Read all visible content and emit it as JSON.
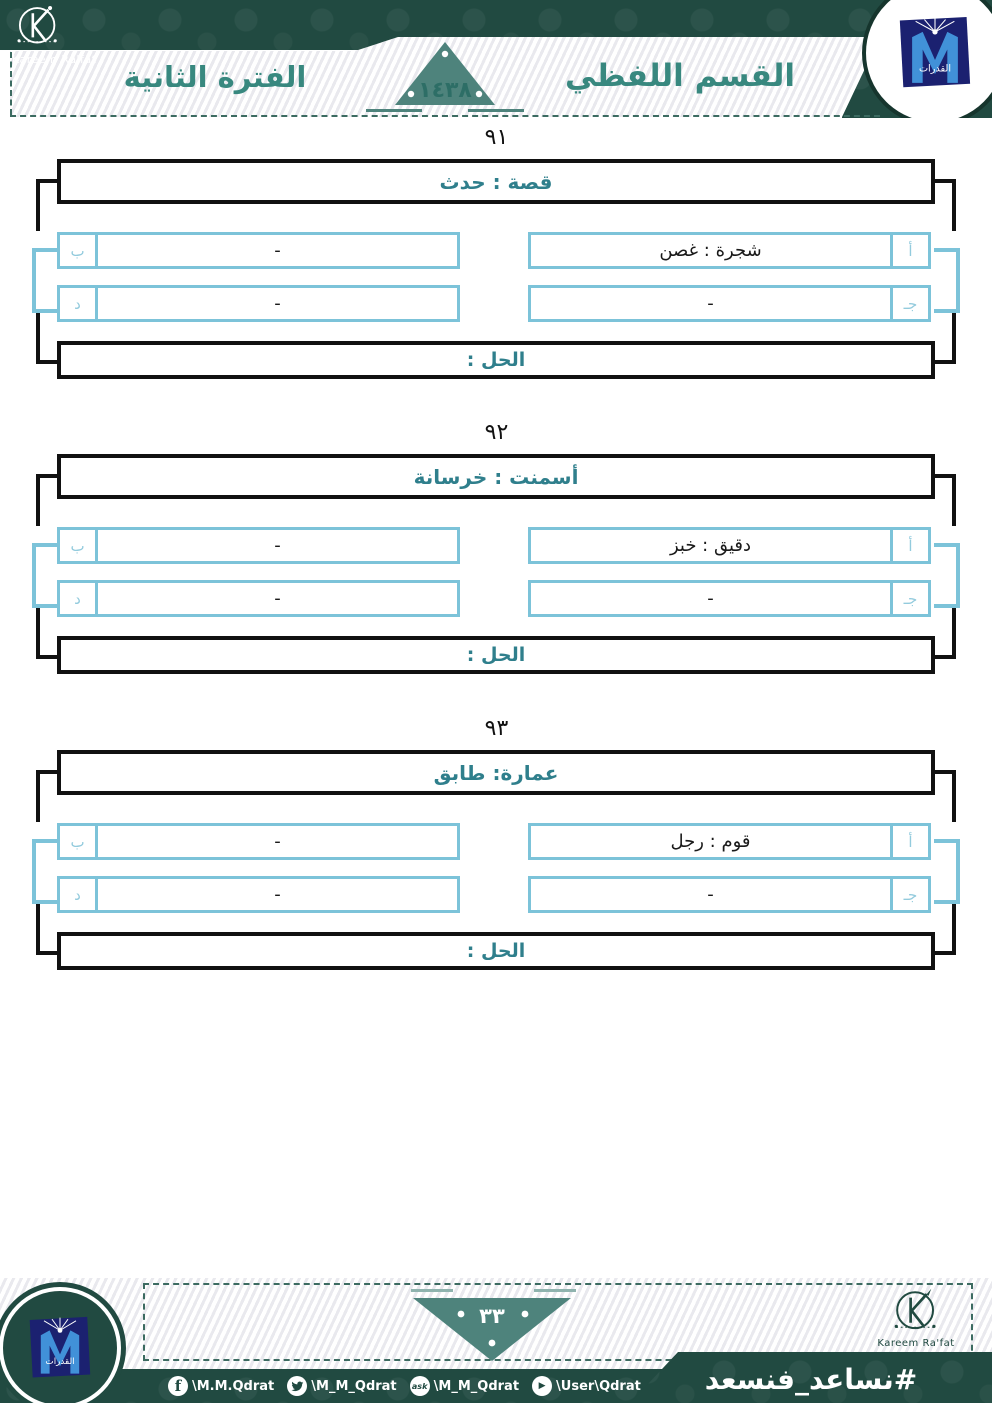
{
  "header": {
    "brand": {
      "name": "Kareem Ra'fat",
      "initial": "K"
    },
    "section_title": "القسم اللفظي",
    "period_title": "الفترة الثانية",
    "year": "١٤٣٨",
    "qudrat_logo_text": "القدرات"
  },
  "questions": [
    {
      "number": "٩١",
      "title": "قصة : حدث",
      "options": [
        {
          "label": "أ",
          "text": "شجرة : غصن"
        },
        {
          "label": "ب",
          "text": "-"
        },
        {
          "label": "جـ",
          "text": "-"
        },
        {
          "label": "د",
          "text": "-"
        }
      ],
      "solution_label": "الحل :"
    },
    {
      "number": "٩٢",
      "title": "أسمنت : خرسانة",
      "options": [
        {
          "label": "أ",
          "text": "دقيق : خبز"
        },
        {
          "label": "ب",
          "text": "-"
        },
        {
          "label": "جـ",
          "text": "-"
        },
        {
          "label": "د",
          "text": "-"
        }
      ],
      "solution_label": "الحل :"
    },
    {
      "number": "٩٣",
      "title": "عمارة: طابق",
      "options": [
        {
          "label": "أ",
          "text": "قوم : رجل"
        },
        {
          "label": "ب",
          "text": "-"
        },
        {
          "label": "جـ",
          "text": "-"
        },
        {
          "label": "د",
          "text": "-"
        }
      ],
      "solution_label": "الحل :"
    }
  ],
  "footer": {
    "page_number": "٣٣",
    "hashtag": "#نساعد_فنسعد",
    "socials": [
      {
        "icon": "facebook-icon",
        "handle": "\\M.M.Qdrat"
      },
      {
        "icon": "twitter-icon",
        "handle": "\\M_M_Qdrat"
      },
      {
        "icon": "ask-icon",
        "handle": "\\M_M_Qdrat"
      },
      {
        "icon": "youtube-icon",
        "handle": "\\User\\Qdrat"
      }
    ],
    "brand": "Kareem Ra'fat",
    "qudrat_logo_text": "القدرات"
  },
  "colors": {
    "dark_green": "#214a41",
    "teal_triangle": "#4e837c",
    "teal_text": "#38887f",
    "title_teal": "#2f7f8c",
    "light_blue": "#7cc3d9",
    "navy": "#1b2170",
    "logo_blue": "#4191d8"
  }
}
